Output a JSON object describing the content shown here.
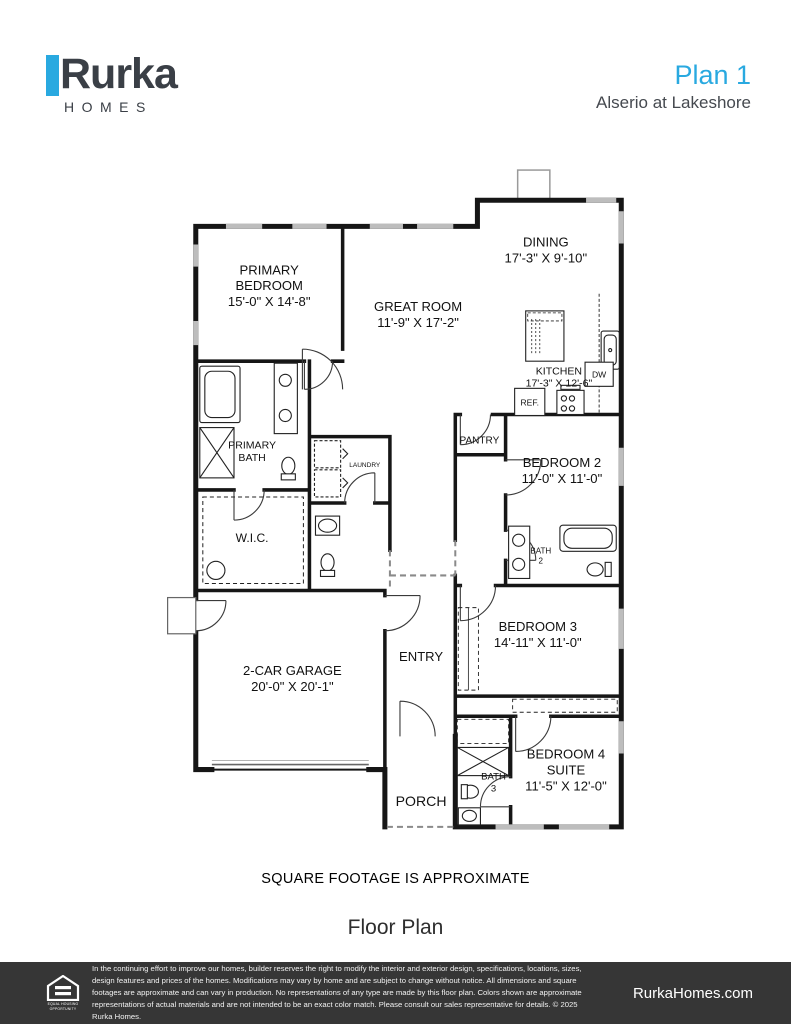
{
  "header": {
    "brand": "Rurka",
    "brand_sub": "HOMES",
    "plan_title": "Plan 1",
    "community": "Alserio at Lakeshore"
  },
  "colors": {
    "accent_blue": "#29A9E0",
    "footer_bg": "#363636",
    "wall": "#161616",
    "window_gray": "#bdbdbd"
  },
  "plan": {
    "labels": {
      "primary_bedroom": [
        "PRIMARY",
        "BEDROOM",
        "15'-0\" X 14'-8\""
      ],
      "great_room": [
        "GREAT ROOM",
        "11'-9\" X 17'-2\""
      ],
      "dining": [
        "DINING",
        "17'-3\" X 9'-10\""
      ],
      "kitchen": [
        "KITCHEN",
        "17'-3\" X 12'-6\""
      ],
      "pantry": "PANTRY",
      "ref": "REF.",
      "dw": "DW",
      "laundry": "LAUNDRY",
      "primary_bath": [
        "PRIMARY",
        "BATH"
      ],
      "wic": "W.I.C.",
      "bedroom2": [
        "BEDROOM 2",
        "11'-0\" X 11'-0\""
      ],
      "bath2": [
        "BATH",
        "2"
      ],
      "bedroom3": [
        "BEDROOM 3",
        "14'-11\" X 11'-0\""
      ],
      "entry": "ENTRY",
      "garage": [
        "2-CAR GARAGE",
        "20'-0\" X 20'-1\""
      ],
      "porch": "PORCH",
      "bedroom4": [
        "BEDROOM 4",
        "SUITE",
        "11'-5\" X 12'-0\""
      ],
      "bath3": [
        "BATH",
        "3"
      ]
    }
  },
  "notes": {
    "sqft": "SQUARE FOOTAGE IS APPROXIMATE",
    "caption": "Floor Plan"
  },
  "footer": {
    "disclaimer": "In the continuing effort to improve our homes, builder reserves the right to modify the interior and exterior design, specifications, locations, sizes, design features and prices of the homes. Modifications may vary by home and are subject to change without notice. All dimensions and square footages are approximate and can vary in production. No representations of any type are made by this floor plan. Colors shown are approximate representations of actual materials and are not intended to be an exact color match. Please consult our sales representative for details. © 2025 Rurka Homes.",
    "website": "RurkaHomes.com",
    "eho_label": "EQUAL HOUSING OPPORTUNITY"
  }
}
